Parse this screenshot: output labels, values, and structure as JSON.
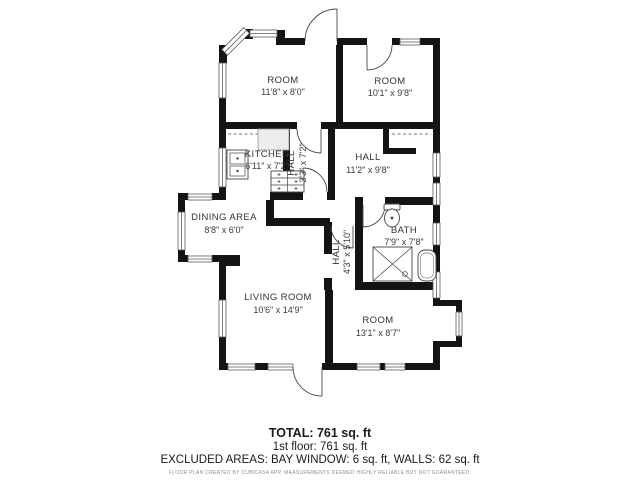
{
  "plan": {
    "rooms": [
      {
        "name": "ROOM",
        "dims": "11'8\" x 8'0\""
      },
      {
        "name": "ROOM",
        "dims": "10'1\" x 9'8\""
      },
      {
        "name": "KITCHEN",
        "dims": "6'11\" x 7'2\""
      },
      {
        "name": "HALL",
        "dims": "3'3\" x 7'2\""
      },
      {
        "name": "HALL",
        "dims": "11'2\" x 9'8\""
      },
      {
        "name": "DINING AREA",
        "dims": "8'8\" x 6'0\""
      },
      {
        "name": "BATH",
        "dims": "7'9\" x 7'8\""
      },
      {
        "name": "HALL",
        "dims": "4'3\" x 5'10\""
      },
      {
        "name": "LIVING ROOM",
        "dims": "10'6\" x 14'9\""
      },
      {
        "name": "ROOM",
        "dims": "13'1\" x 8'7\""
      }
    ],
    "fixtures": [
      "kitchen-sink",
      "kitchen-counter",
      "stove",
      "wardrobe",
      "toilet",
      "shower",
      "bathtub",
      "bay-window"
    ],
    "colors": {
      "wall": "#141414",
      "fixture_line": "#444444",
      "label": "#333333"
    }
  },
  "summary": {
    "total": "TOTAL: 761 sq. ft",
    "floor1": "1st floor: 761 sq. ft",
    "excluded": "EXCLUDED AREAS: BAY WINDOW: 6 sq. ft, WALLS: 62 sq. ft",
    "disclaimer": "FLOOR PLAN CREATED BY CUBICASA APP. MEASUREMENTS DEEMED HIGHLY RELIABLE BUT NOT GUARANTEED."
  }
}
